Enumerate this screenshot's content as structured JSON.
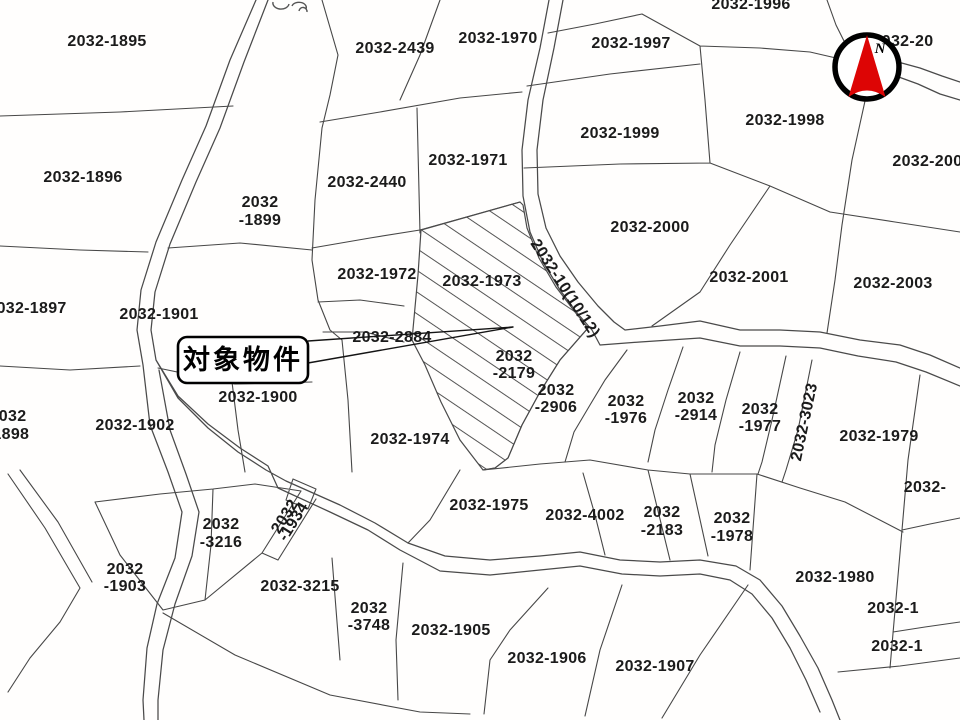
{
  "map": {
    "title": "cadastral-parcel-map",
    "colors": {
      "background": "#fffefd",
      "boundary_line": "#474747",
      "label_text": "#1b1b1b",
      "compass_red": "#dd0505",
      "callout_border": "#000000"
    },
    "callout": {
      "text": "対象物件"
    },
    "compass": {
      "label": "N"
    },
    "subject_parcel": {
      "style": "diagonal-hatch",
      "pointed_by": "callout-arrow"
    },
    "labels": [
      {
        "text": "2032-1895",
        "x": 107,
        "y": 46
      },
      {
        "text": "2032-2439",
        "x": 395,
        "y": 53
      },
      {
        "text": "2032-1970",
        "x": 498,
        "y": 43
      },
      {
        "text": "2032-1996",
        "x": 751,
        "y": 9
      },
      {
        "text": "2032-20",
        "x": 903,
        "y": 46,
        "anchor": "start"
      },
      {
        "text": "2032-1997",
        "x": 631,
        "y": 48
      },
      {
        "text": "2032-1998",
        "x": 785,
        "y": 125
      },
      {
        "text": "2032-2002",
        "x": 932,
        "y": 166
      },
      {
        "text": "2032-1896",
        "x": 83,
        "y": 182
      },
      {
        "lines": [
          "2032",
          "-1899"
        ],
        "x": 260,
        "y": 207,
        "lh": 18
      },
      {
        "text": "2032-2440",
        "x": 367,
        "y": 187
      },
      {
        "text": "2032-1971",
        "x": 468,
        "y": 165
      },
      {
        "text": "2032-1999",
        "x": 620,
        "y": 138
      },
      {
        "text": "2032-2000",
        "x": 650,
        "y": 232
      },
      {
        "text": "2032-2001",
        "x": 749,
        "y": 282
      },
      {
        "text": "2032-2003",
        "x": 893,
        "y": 288
      },
      {
        "text": "2032-1972",
        "x": 377,
        "y": 279
      },
      {
        "text": "2032-1973",
        "x": 482,
        "y": 286
      },
      {
        "text": "2032-10(10/12)",
        "x": 561,
        "y": 291,
        "rotate": 57,
        "size": 10.5
      },
      {
        "text": "2032-1897",
        "x": 27,
        "y": 313
      },
      {
        "text": "2032-1901",
        "x": 159,
        "y": 319
      },
      {
        "text": "2032-2884",
        "x": 392,
        "y": 342
      },
      {
        "lines": [
          "2032",
          "-2179"
        ],
        "x": 514,
        "y": 361,
        "lh": 17
      },
      {
        "text": "2032-1900",
        "x": 258,
        "y": 402
      },
      {
        "lines": [
          "2032",
          "-2906"
        ],
        "x": 556,
        "y": 395,
        "lh": 17
      },
      {
        "lines": [
          "2032",
          "-1976"
        ],
        "x": 626,
        "y": 406,
        "lh": 17
      },
      {
        "lines": [
          "2032",
          "-2914"
        ],
        "x": 696,
        "y": 403,
        "lh": 17
      },
      {
        "lines": [
          "2032",
          "-1977"
        ],
        "x": 760,
        "y": 414,
        "lh": 17
      },
      {
        "text": "2032-3023",
        "x": 809,
        "y": 423,
        "rotate": -78,
        "size": 15.5
      },
      {
        "text": "2032-1979",
        "x": 879,
        "y": 441
      },
      {
        "lines": [
          "2032",
          "-1898"
        ],
        "x": 8,
        "y": 421,
        "lh": 18
      },
      {
        "text": "2032-1902",
        "x": 135,
        "y": 430
      },
      {
        "text": "2032-1974",
        "x": 410,
        "y": 444
      },
      {
        "text": "2032-",
        "x": 925,
        "y": 492,
        "anchor": "start"
      },
      {
        "text": "2032-1975",
        "x": 489,
        "y": 510
      },
      {
        "text": "2032-4002",
        "x": 585,
        "y": 520
      },
      {
        "lines": [
          "2032",
          "-2183"
        ],
        "x": 662,
        "y": 517,
        "lh": 18
      },
      {
        "lines": [
          "2032",
          "-1978"
        ],
        "x": 732,
        "y": 523,
        "lh": 18
      },
      {
        "lines": [
          "2032",
          "-3216"
        ],
        "x": 221,
        "y": 529,
        "lh": 18
      },
      {
        "lines": [
          "2032",
          "-1934"
        ],
        "x": 289,
        "y": 519,
        "lh": 10,
        "rotate": -58,
        "size": 10
      },
      {
        "lines": [
          "2032",
          "-1903"
        ],
        "x": 125,
        "y": 574,
        "lh": 17
      },
      {
        "text": "2032-3215",
        "x": 300,
        "y": 591
      },
      {
        "text": "2032-1980",
        "x": 835,
        "y": 582
      },
      {
        "lines": [
          "2032",
          "-3748"
        ],
        "x": 369,
        "y": 613,
        "lh": 17
      },
      {
        "text": "2032-1905",
        "x": 451,
        "y": 635
      },
      {
        "text": "2032-1906",
        "x": 547,
        "y": 663
      },
      {
        "text": "2032-1907",
        "x": 655,
        "y": 671
      },
      {
        "text": "2032-1",
        "x": 893,
        "y": 613,
        "anchor": "start"
      },
      {
        "text": "2032-1",
        "x": 897,
        "y": 651,
        "anchor": "start"
      }
    ]
  }
}
